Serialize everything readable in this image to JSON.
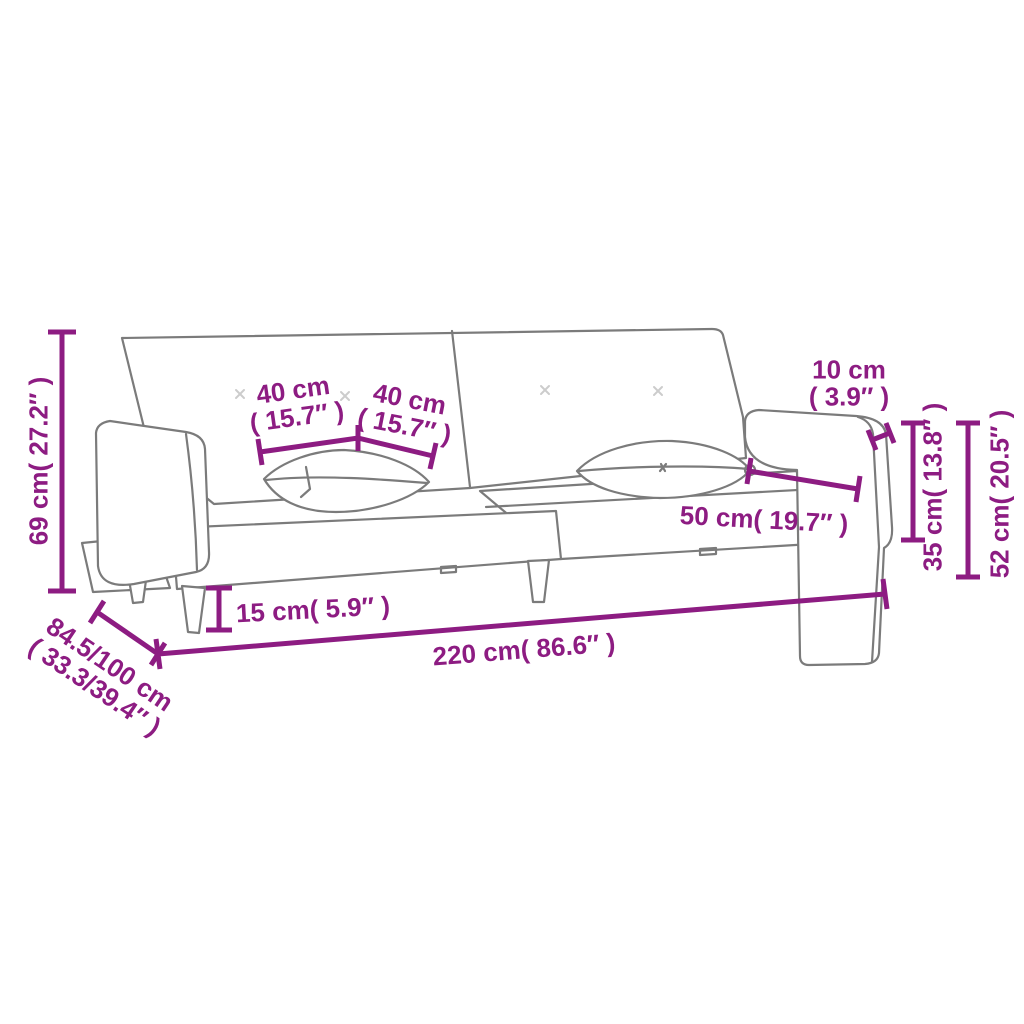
{
  "page": {
    "background": "#ffffff"
  },
  "colors": {
    "dimension": "#8d1c82",
    "sketch": "#7b7b7b",
    "tuft": "#cccccc"
  },
  "dimensions": {
    "height": {
      "label": "69 cm( 27.2″ )"
    },
    "depth": {
      "line1": "84.5/100 cm",
      "line2": "( 33.3/39.4″ )"
    },
    "leg_height": {
      "label": "15 cm( 5.9″ )"
    },
    "total_width": {
      "label": "220 cm( 86.6″ )"
    },
    "pillow_left": {
      "line1": "40 cm",
      "line2": "( 15.7″ )"
    },
    "pillow_right": {
      "line1": "40 cm",
      "line2": "( 15.7″ )"
    },
    "armrest_width": {
      "line1": "10 cm",
      "line2": "( 3.9″ )"
    },
    "seat_depth": {
      "label": "50 cm( 19.7″ )"
    },
    "armrest_height": {
      "label": "35 cm( 13.8″ )"
    },
    "side_height": {
      "label": "52 cm( 20.5″ )"
    }
  }
}
